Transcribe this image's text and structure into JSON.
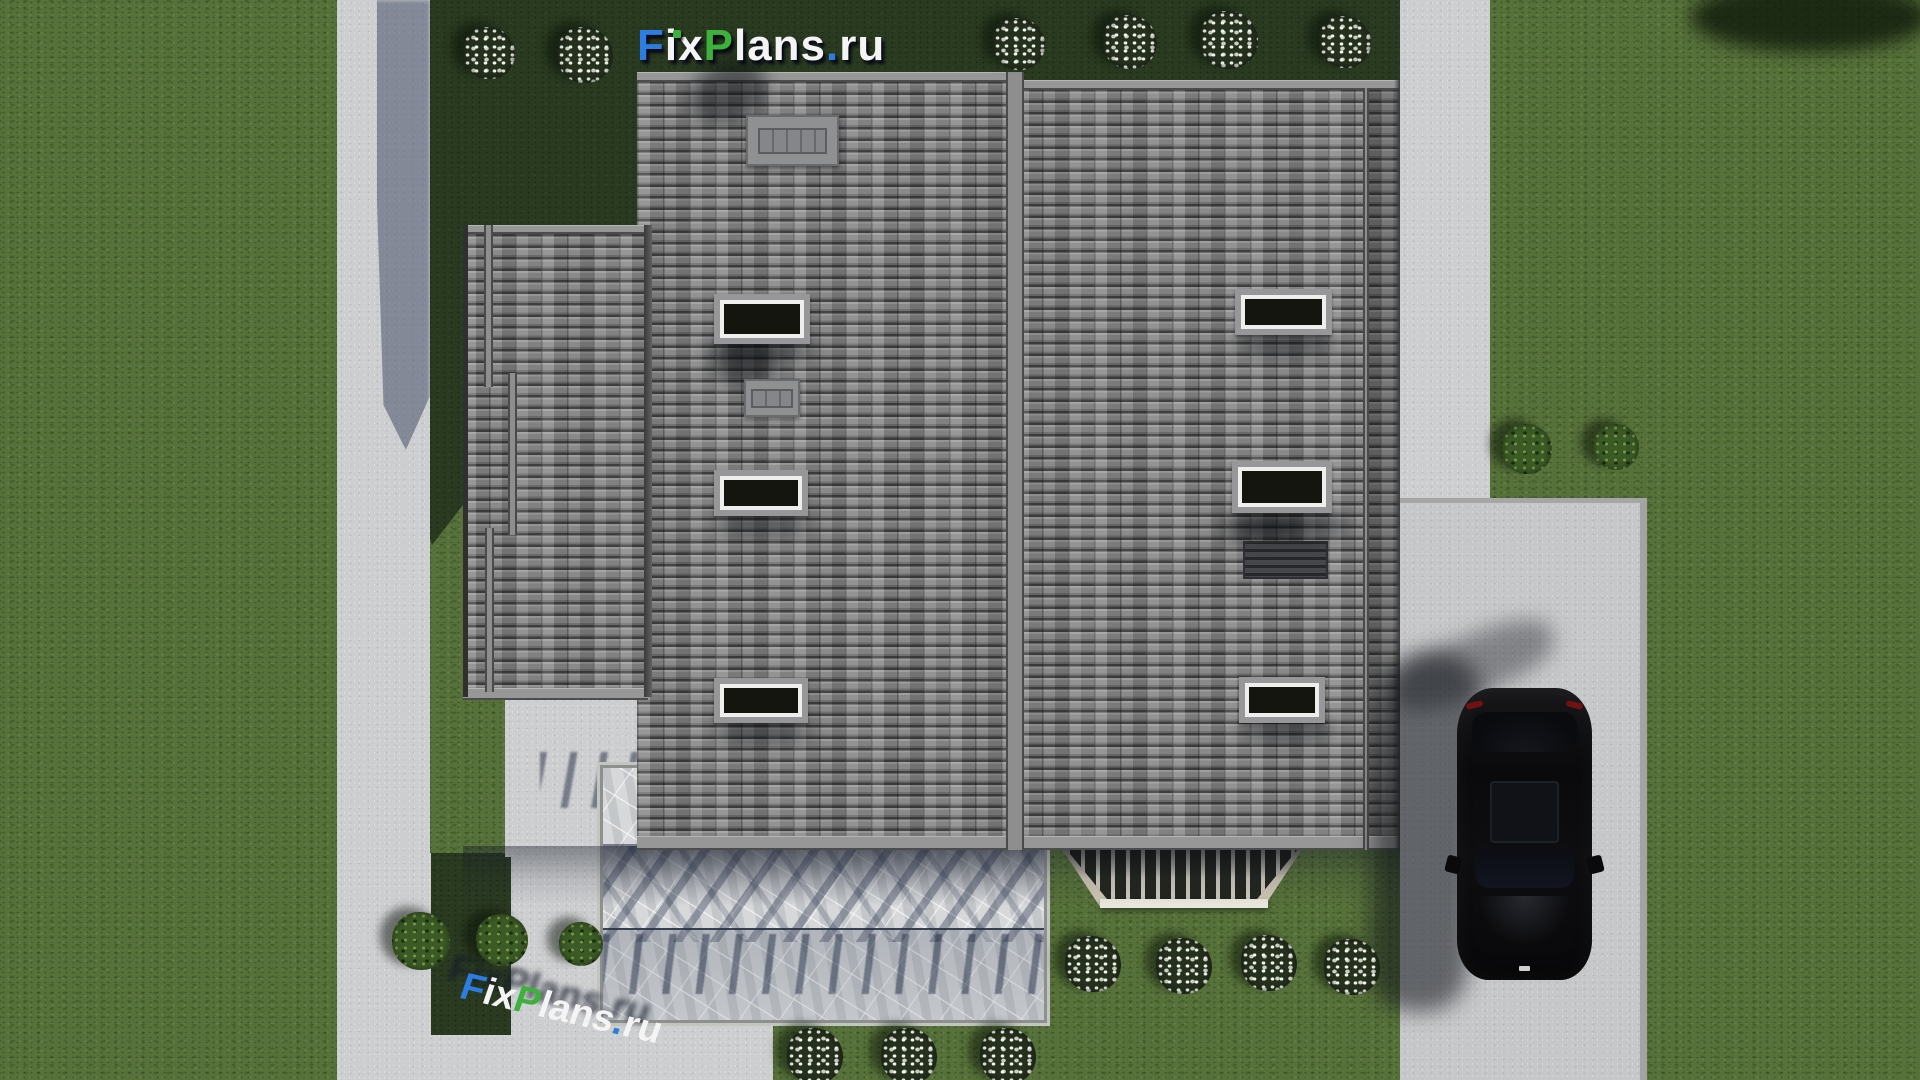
{
  "meta": {
    "render_type": "3d-architectural-site-plan-render",
    "view": "top-down aerial",
    "canvas": "1920x1080"
  },
  "branding": {
    "logo_text": "FixPlans.ru",
    "logo_segments": [
      {
        "text": "F",
        "color": "#2b7de0"
      },
      {
        "text": "i",
        "color": "#f4f4f4"
      },
      {
        "text": "x",
        "color": "#f4f4f4"
      },
      {
        "text": "P",
        "color": "#3cb23c"
      },
      {
        "text": "lans",
        "color": "#f4f4f4"
      },
      {
        "text": ".",
        "color": "#2b7de0"
      },
      {
        "text": "ru",
        "color": "#f4f4f4"
      }
    ],
    "i_dot_color": "#3cb23c",
    "watermark_text": "FixPlans.ru"
  },
  "scene": {
    "house": {
      "roof_material": "gray concrete tiles",
      "roof_sections": 3,
      "skylight_count": 6,
      "chimney_count": 2,
      "roof_vent_count": 1,
      "porch": "marble terrace with balustrade shadows",
      "bay_terrace": "trapezoid railing terrace"
    },
    "car": {
      "color": "black",
      "state": "parked on driveway",
      "features": [
        "sunroof",
        "taillights",
        "side mirrors"
      ]
    },
    "landscape": {
      "white_flower_bushes": 13,
      "green_shrubs": 5,
      "paths": [
        "left walkway",
        "right walkway",
        "driveway",
        "bottom-left apron"
      ]
    }
  },
  "palette": {
    "grass_sunlit": "#57713a",
    "grass_shadow": "#2a3a21",
    "concrete": "#cdced0",
    "concrete_drive": "#c6c7c9",
    "roof_tile": "#7e7e7e",
    "roof_trim": "#979797",
    "marble": "#d6d8da",
    "bay_frame": "#cfc7b6",
    "skylight_glass": "#15150f",
    "frame_white": "#eeeeec",
    "frame_gray": "#97979a",
    "car_body": "#0b0b0d",
    "logo_blue": "#2b7de0",
    "logo_green": "#3cb23c",
    "logo_white": "#f4f4f4"
  }
}
